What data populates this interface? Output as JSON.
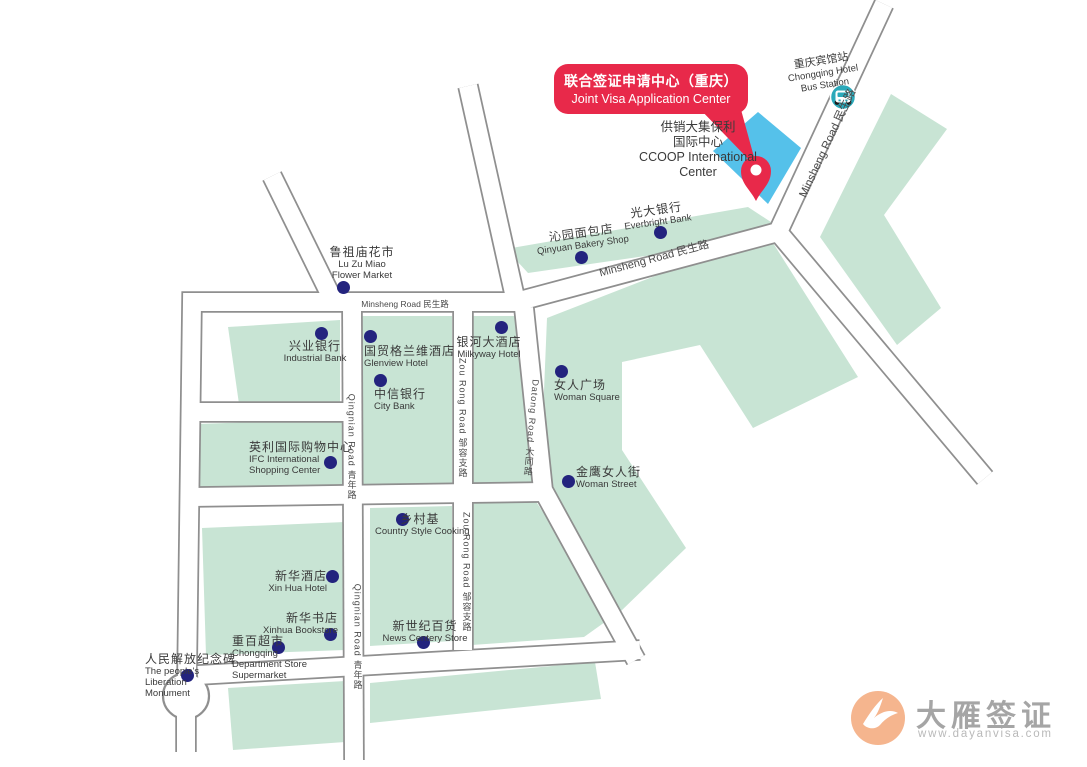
{
  "callout": {
    "line_zh": "联合签证申请中心（重庆）",
    "line_en": "Joint Visa Application Center"
  },
  "ccoop": {
    "lines": [
      "供销大集保利",
      "国际中心",
      "CCOOP International",
      "Center"
    ]
  },
  "bus_station": {
    "line1": "重庆宾馆站",
    "line2": "Chongqing Hotel",
    "line3": "Bus Station"
  },
  "logo": {
    "name": "大雁签证",
    "url": "www.dayanvisa.com",
    "goose_icon": "goose-icon"
  },
  "colors": {
    "accent_red": "#E8294A",
    "map_green": "#C8E4D4",
    "building_blue": "#55C1EA",
    "poi_dot_navy": "#23237E",
    "road_edge_gray": "#8F8F8F",
    "bus_teal": "#2BA9BA",
    "logo_orange": "#F5B58E"
  },
  "map": {
    "pois": [
      {
        "id": "flower-market",
        "zh": "鲁祖庙花市",
        "en": [
          "Lu Zu Miao",
          "Flower Market"
        ],
        "dot": {
          "x": 343,
          "y": 287
        },
        "label": {
          "x": 307,
          "y": 245,
          "w": 110,
          "align": "center"
        }
      },
      {
        "id": "industrial-bank",
        "zh": "兴业银行",
        "en": [
          "Industrial Bank"
        ],
        "dot": {
          "x": 321,
          "y": 333
        },
        "label": {
          "x": 260,
          "y": 339,
          "w": 110,
          "align": "center"
        }
      },
      {
        "id": "glenview-hotel",
        "zh": "国贸格兰维酒店",
        "en": [
          "Glenview Hotel"
        ],
        "dot": {
          "x": 370,
          "y": 336
        },
        "label": {
          "x": 364,
          "y": 344,
          "w": 100,
          "align": "left"
        }
      },
      {
        "id": "city-bank",
        "zh": "中信银行",
        "en": [
          "City Bank"
        ],
        "dot": {
          "x": 380,
          "y": 380
        },
        "label": {
          "x": 374,
          "y": 387,
          "w": 90,
          "align": "left"
        }
      },
      {
        "id": "milkyway-hotel",
        "zh": "银河大酒店",
        "en": [
          "Milkyway Hotel"
        ],
        "dot": {
          "x": 501,
          "y": 327
        },
        "label": {
          "x": 439,
          "y": 335,
          "w": 100,
          "align": "center"
        }
      },
      {
        "id": "everbright-bank",
        "zh": "光大银行",
        "en": [
          "Everbright Bank"
        ],
        "dot": {
          "x": 660,
          "y": 232
        },
        "label": {
          "x": 602,
          "y": 203,
          "w": 110,
          "align": "center"
        },
        "rotate": -8
      },
      {
        "id": "qinyuan-bakery",
        "zh": "沁园面包店",
        "en": [
          "Qinyuan Bakery Shop"
        ],
        "dot": {
          "x": 581,
          "y": 257
        },
        "label": {
          "x": 517,
          "y": 226,
          "w": 130,
          "align": "center"
        },
        "rotate": -8
      },
      {
        "id": "woman-square",
        "zh": "女人广场",
        "en": [
          "Woman Square"
        ],
        "dot": {
          "x": 561,
          "y": 371
        },
        "label": {
          "x": 554,
          "y": 378,
          "w": 90,
          "align": "left"
        }
      },
      {
        "id": "woman-street",
        "zh": "金鹰女人街",
        "en": [
          "Woman Street"
        ],
        "dot": {
          "x": 568,
          "y": 481
        },
        "label": {
          "x": 576,
          "y": 465,
          "w": 90,
          "align": "left"
        }
      },
      {
        "id": "ifc-shopping-center",
        "zh": "英利国际购物中心",
        "en": [
          "IFC International",
          "Shopping Center"
        ],
        "dot": {
          "x": 330,
          "y": 462
        },
        "label": {
          "x": 249,
          "y": 440,
          "w": 110,
          "align": "left"
        }
      },
      {
        "id": "xinhua-hotel",
        "zh": "新华酒店",
        "en": [
          "Xin Hua Hotel"
        ],
        "dot": {
          "x": 332,
          "y": 576
        },
        "label": {
          "x": 240,
          "y": 569,
          "w": 87,
          "align": "right"
        }
      },
      {
        "id": "xinhua-bookstore",
        "zh": "新华书店",
        "en": [
          "Xinhua Bookstore"
        ],
        "dot": {
          "x": 330,
          "y": 634
        },
        "label": {
          "x": 250,
          "y": 611,
          "w": 88,
          "align": "right"
        }
      },
      {
        "id": "chongqing-department-store",
        "zh": "重百超市",
        "en": [
          "Chongqing",
          "Department Store",
          "Supermarket"
        ],
        "dot": {
          "x": 278,
          "y": 647
        },
        "label": {
          "x": 232,
          "y": 634,
          "w": 85,
          "align": "left"
        }
      },
      {
        "id": "country-style-cooking",
        "zh": "乡村基",
        "en": [
          "Country Style Cooking"
        ],
        "dot": {
          "x": 402,
          "y": 519
        },
        "label": {
          "x": 375,
          "y": 512,
          "w": 90,
          "align": "center"
        }
      },
      {
        "id": "news-century-store",
        "zh": "新世纪百货",
        "en": [
          "News Centery Store"
        ],
        "dot": {
          "x": 423,
          "y": 642
        },
        "label": {
          "x": 380,
          "y": 619,
          "w": 90,
          "align": "center"
        }
      },
      {
        "id": "liberation-monument",
        "zh": "人民解放纪念碑",
        "en": [
          "The people's",
          "Liberation",
          "Monument"
        ],
        "dot": {
          "x": 187,
          "y": 675
        },
        "label": {
          "x": 145,
          "y": 652,
          "w": 90,
          "align": "left"
        }
      }
    ],
    "road_labels": [
      {
        "id": "minsheng-road-ne",
        "text": "Minsheng Road 民生路",
        "x": 827,
        "y": 143,
        "rotate": -65,
        "size": 11.5
      },
      {
        "id": "minsheng-road-mid",
        "text": "Minsheng Road 民生路",
        "x": 654,
        "y": 258,
        "rotate": -15,
        "size": 11
      },
      {
        "id": "minsheng-road-west",
        "text": "Minsheng Road 民生路",
        "x": 405,
        "y": 304,
        "rotate": 0,
        "size": 8.5
      },
      {
        "id": "qingnian-road-north",
        "text": "Qingnian Road 青年路",
        "x": 352,
        "y": 447,
        "vertical": true,
        "size": 9
      },
      {
        "id": "qingnian-road-south",
        "text": "Qingnian Road 青年路",
        "x": 358,
        "y": 637,
        "vertical": true,
        "size": 9
      },
      {
        "id": "zourong-road-north",
        "text": "Zou Rong Road 邹容支路",
        "x": 463,
        "y": 418,
        "vertical": true,
        "size": 9
      },
      {
        "id": "zourong-road-south",
        "text": "Zou Rong Road 邹容支路",
        "x": 467,
        "y": 572,
        "vertical": true,
        "size": 9
      },
      {
        "id": "datong-road",
        "text": "Datong Road 大同路",
        "x": 532,
        "y": 428,
        "vertical": true,
        "rotate": 5,
        "size": 9
      }
    ]
  }
}
